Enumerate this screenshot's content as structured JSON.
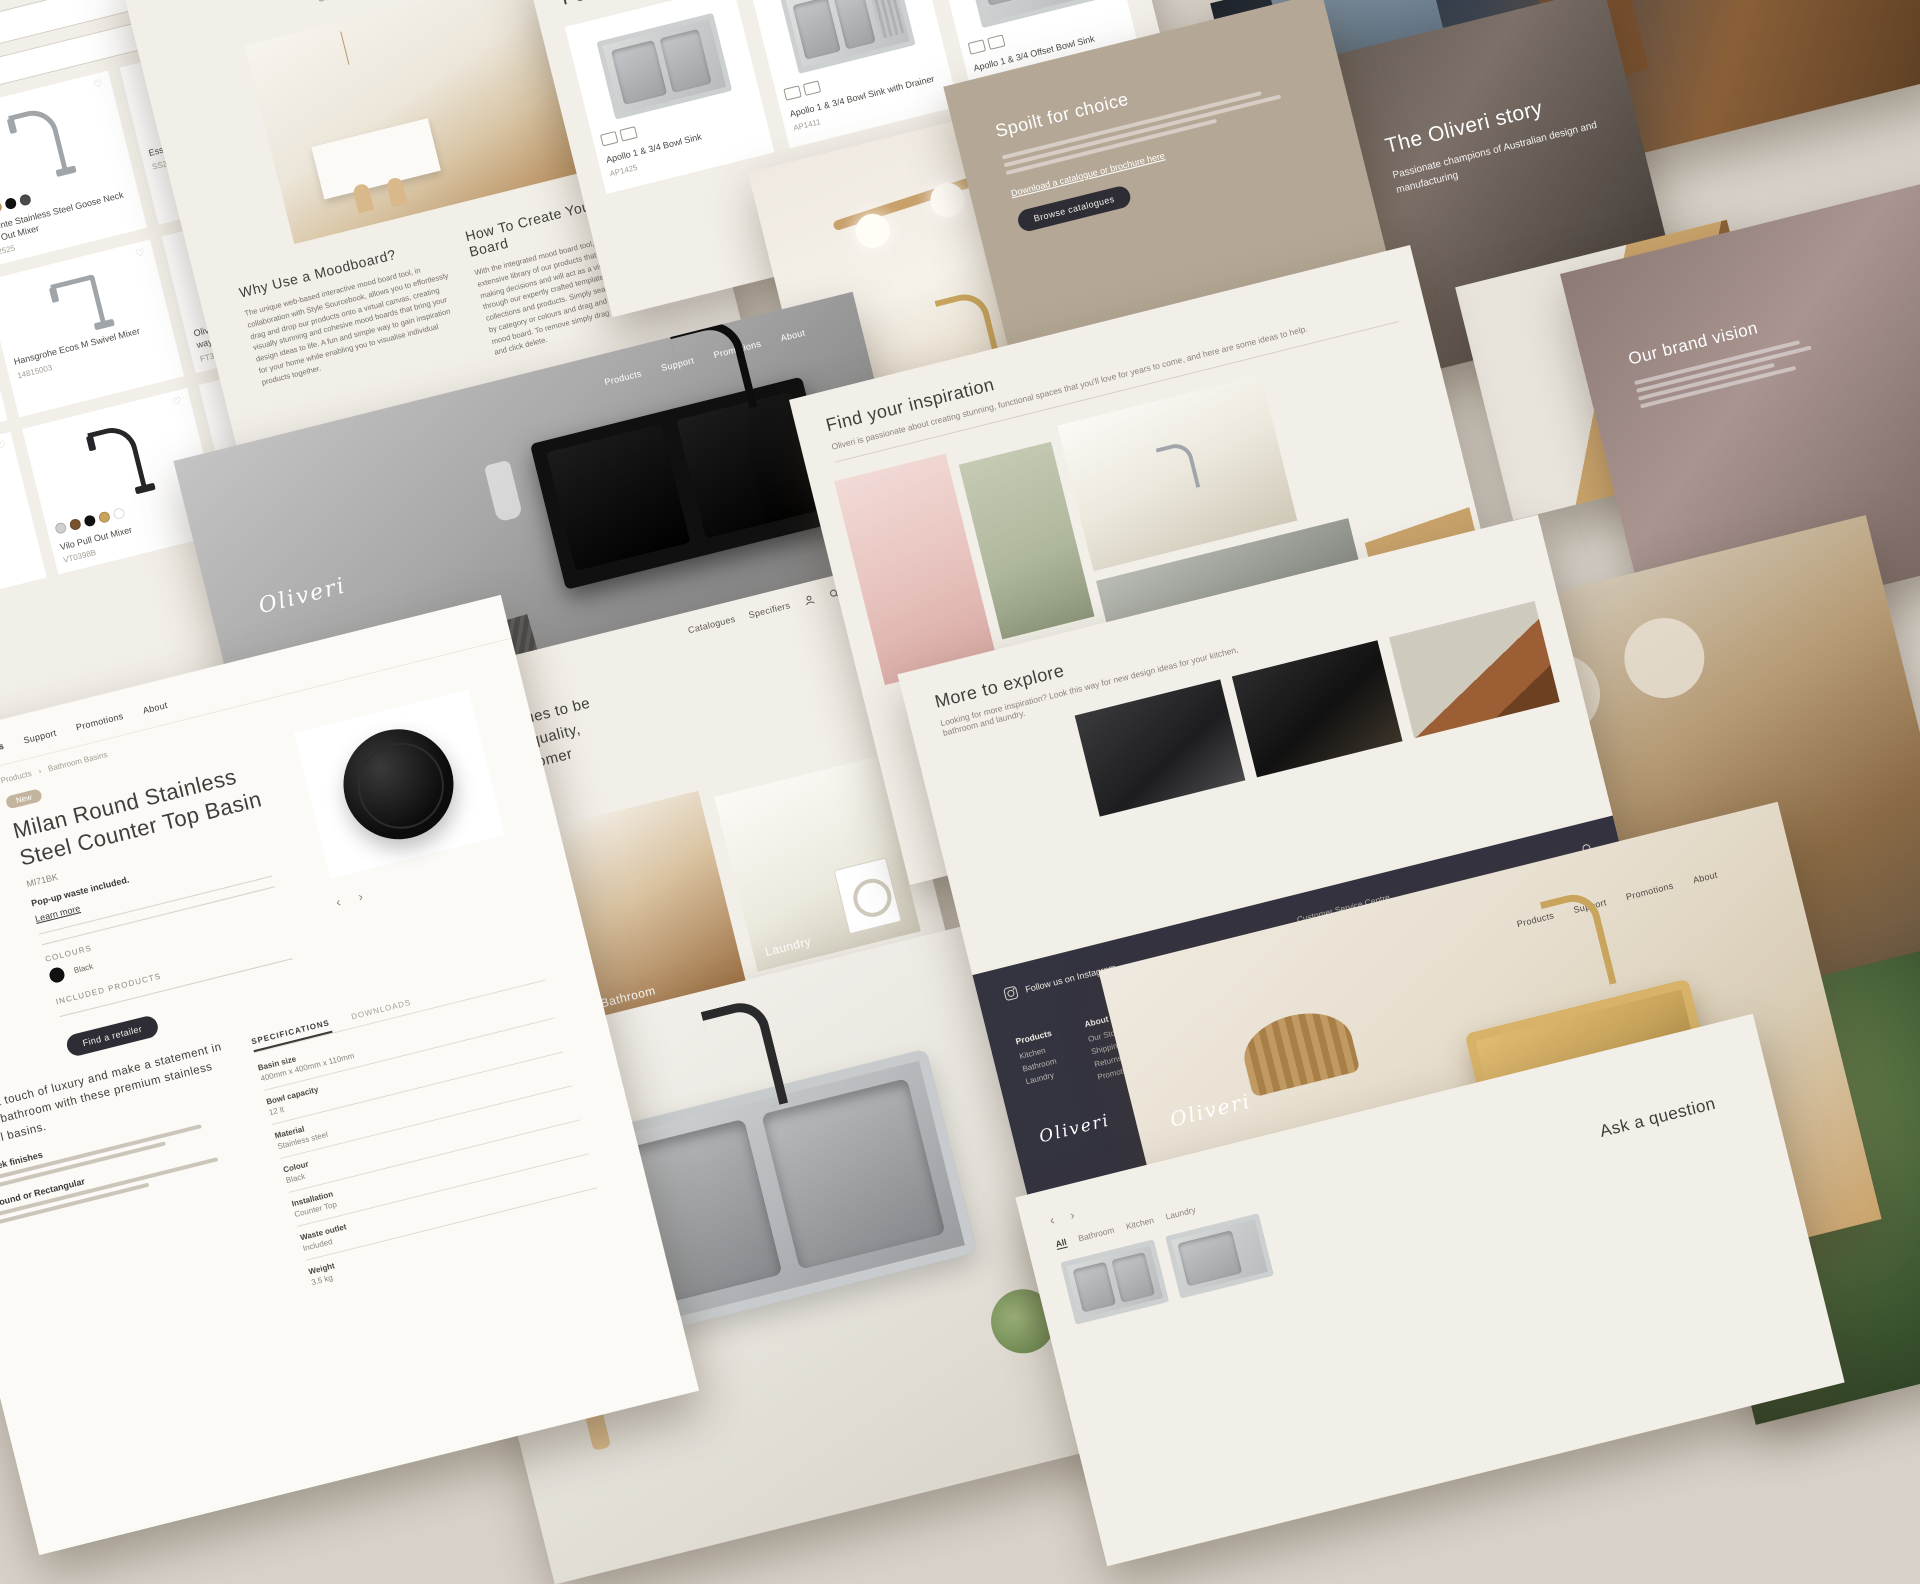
{
  "brand": {
    "name": "Oliveri",
    "accent_dark": "#2e2d35",
    "cream": "#f2efe8",
    "gold": "#c9a45c"
  },
  "icons": {
    "search": "magnifier",
    "home": "house",
    "wishlist": "heart",
    "bag": "shopping-bag",
    "caret_down": "▾",
    "chevron_left": "‹",
    "chevron_right": "›",
    "arrow_right": "→",
    "facebook": "f",
    "pinterest": "p",
    "instagram": "◎",
    "youtube": "▶"
  },
  "nav": {
    "main": [
      "Products",
      "Support",
      "Promotions",
      "About"
    ],
    "utility": [
      "Stocklists",
      "Wishlist",
      "Catalogues",
      "Specifiers"
    ]
  },
  "products_page": {
    "sort": "Title (A to Z)",
    "search_placeholder": "",
    "items": [
      {
        "name": "Essente Stainless Steel Square Goose Neck Mixer",
        "sku": "",
        "swatches": [
          "#111111"
        ]
      },
      {
        "name": "Essente Stainless Steel Goose Neck Pull Out Mixer",
        "sku": "SS2525",
        "swatches": [
          "#bdbdbd",
          "#c9a45c",
          "#111111",
          "#4a4a4a"
        ]
      },
      {
        "name": "Essente Stainless Steel Swivel Mixer",
        "sku": "SS2510",
        "swatches": []
      },
      {
        "name": "Pull Out Spray Mixer",
        "sku": "",
        "swatches": []
      },
      {
        "name": "Hansgrohe Ecos M Swivel Mixer",
        "sku": "14815003",
        "swatches": []
      },
      {
        "name": "Oliveri Essentials round goose neck 3 way filter tap",
        "sku": "FT3EGN",
        "swatches": []
      },
      {
        "name": "Pepe Swivel Mixer",
        "sku": "PT2010B",
        "swatches": [
          "#e0e0e0",
          "#111111",
          "#9a9a9a",
          "#111111"
        ]
      },
      {
        "name": "Vilo Pull Out Mixer",
        "sku": "VT0398B",
        "swatches": [
          "#d0d0d0",
          "#9a9a9a",
          "#7a5230",
          "#444444",
          "#111111",
          "#c9a45c",
          "#ffffff"
        ]
      },
      {
        "name": "Vilo Pull Out Mixer",
        "sku": "VT0421",
        "swatches": [
          "#d0d0d0",
          "#9a9a9a",
          "#111111"
        ]
      }
    ]
  },
  "moodboard": {
    "title": "Source",
    "subtitle": "Create a moodboard with our products",
    "why_title": "Why Use a Moodboard?",
    "why_text": "The unique web-based interactive mood board tool, in collaboration with Style Sourcebook, allows you to effortlessly drag and drop our products onto a virtual canvas, creating visually stunning and cohesive mood boards that bring your design ideas to life. A fun and simple way to gain inspiration for your home while enabling you to visualise individual products together.",
    "how_title": "How To Create Your Mood Board",
    "how_text": "With the integrated mood board tool, you'll have access to an extensive library of our products that can assist you in making decisions and will act as a visual guide. Browse through our expertly crafted templates, featuring the latest collections and products. Simply search by specific brands, by category or colours and drag and drop items onto the mood board. To remove simply drag the item off the board and click delete.",
    "cta": "Create a Mood Board"
  },
  "spectra": {
    "title": "Spectra Sinks",
    "subtitle": "Spectra coloured stainless steel kitchen or laundry sinks.",
    "cta": "View the range"
  },
  "featured": {
    "title": "Featured products",
    "items": [
      {
        "name": "Apollo 1 & 3/4 Bowl Sink",
        "sku": "AP1425"
      },
      {
        "name": "Apollo 1 & 3/4 Bowl Sink with Drainer",
        "sku": "AP1411"
      },
      {
        "name": "Apollo 1 & 3/4 Offset Bowl Sink",
        "sku": "AP1415"
      }
    ]
  },
  "spoilt": {
    "title": "Spoilt for choice",
    "link": "Download a catalogue or brochure here",
    "cta": "Browse catalogues"
  },
  "story": {
    "title": "The Oliveri story",
    "subtitle": "Passionate champions of Australian design and manufacturing"
  },
  "vision": {
    "title": "Our brand vision"
  },
  "statement": {
    "text": "The Oliveri name continues to be synonymous with style, quality, reliability and great customer service.",
    "labels": [
      "Kitchen",
      "Bathroom",
      "Laundry"
    ]
  },
  "inspiration": {
    "title": "Find your inspiration",
    "subtitle": "Oliveri is passionate about creating stunning, functional spaces that you'll love for years to come, and here are some ideas to help.",
    "photo_label": "Laundry"
  },
  "explore": {
    "title": "More to explore",
    "subtitle": "Looking for more inspiration? Look this way for new design ideas for your kitchen, bathroom and laundry."
  },
  "footer": {
    "instagram": "Follow us on Instagram",
    "phone_label": "Customer Service Centre",
    "phone": "08 8348 6444",
    "register": "Register for email updates",
    "columns": [
      {
        "title": "Products",
        "items": [
          "Kitchen",
          "Bathroom",
          "Laundry"
        ]
      },
      {
        "title": "About",
        "items": [
          "Our Story",
          "Shipping",
          "Returns",
          "Promotions"
        ]
      },
      {
        "title": "Support",
        "items": [
          "Resources",
          "Service and Warranty",
          "Catalogues",
          "FAQs"
        ]
      },
      {
        "title": "Find us",
        "items": [
          "Stocklists",
          "Showrooms",
          "Contact Us"
        ]
      }
    ],
    "legal": [
      "Terms & Conditions",
      "Privacy Policy",
      "Terms of Use"
    ],
    "copyright": "© 2022 Oliveri Solutions"
  },
  "milan": {
    "breadcrumb": [
      "Products",
      "Bathroom Basins"
    ],
    "badge": "New",
    "title": "Milan Round Stainless Steel Counter Top Basin",
    "sku": "MI71BK",
    "note": "Pop-up waste included.",
    "learn_more": "Learn more",
    "colours_label": "COLOURS",
    "colour_name": "Black",
    "included_label": "INCLUDED PRODUCTS",
    "cta": "Find a retailer",
    "tabs": [
      "SPECIFICATIONS",
      "DOWNLOADS"
    ],
    "specs": [
      {
        "label": "Basin size",
        "value": "400mm x 400mm x 110mm"
      },
      {
        "label": "Bowl capacity",
        "value": "12 lt"
      },
      {
        "label": "Material",
        "value": "Stainless steel"
      },
      {
        "label": "Colour",
        "value": "Black"
      },
      {
        "label": "Installation",
        "value": "Counter Top"
      },
      {
        "label": "Waste outlet",
        "value": "Included"
      },
      {
        "label": "Weight",
        "value": "3.5 kg"
      }
    ],
    "description": "Add a touch of luxury and make a statement in your bathroom with these premium stainless steel basins.",
    "sub1": "Sleek finishes",
    "sub2": "Round or Rectangular"
  },
  "ask": {
    "title": "Ask a question",
    "filters": [
      "All",
      "Bathroom",
      "Kitchen",
      "Laundry"
    ]
  }
}
